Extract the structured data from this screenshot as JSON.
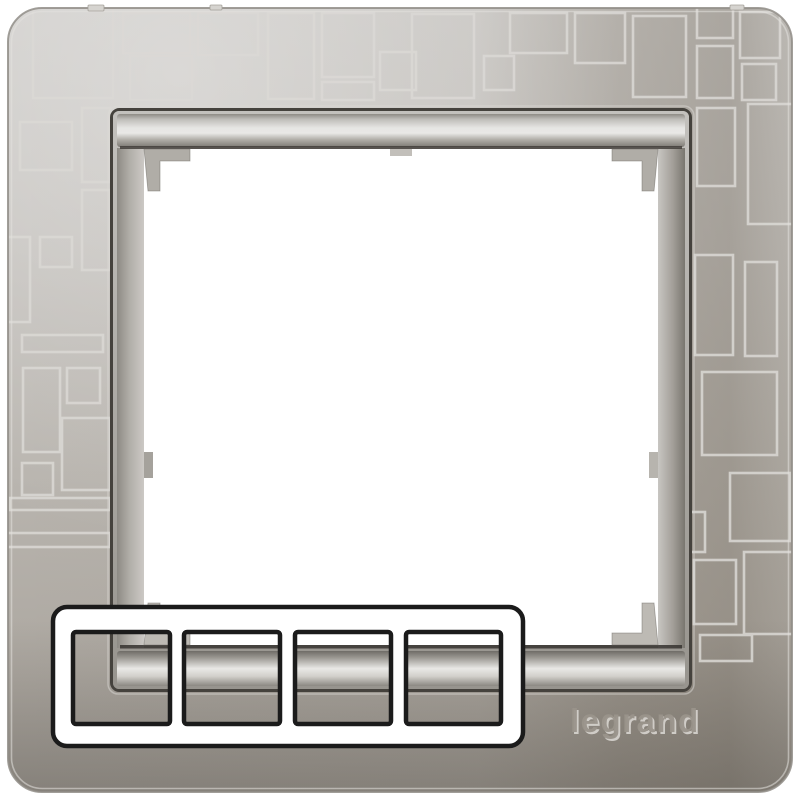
{
  "scene": {
    "description": "Legrand aluminium single wall-plate frame with modern square pattern, 4-gang schematic overlay",
    "background": "#ffffff"
  },
  "brand_logo": {
    "text": "legrand"
  },
  "colors": {
    "background": "#ffffff",
    "face_silver": "#c0bdb8",
    "face_shadow": "#9c958a",
    "pattern_line": "#dbd9d5",
    "bezel_groove": "#45423d",
    "window": "#ffffff",
    "diagram_stroke": "#1b1b1b",
    "diagram_fill": "#ffffff",
    "logo_emboss": "#9a948b"
  },
  "pattern": {
    "line_color": "#dbd9d5",
    "rects": [
      [
        33,
        8,
        80,
        90
      ],
      [
        123,
        13,
        67,
        40
      ],
      [
        198,
        13,
        60,
        42
      ],
      [
        130,
        56,
        62,
        44
      ],
      [
        268,
        13,
        46,
        86
      ],
      [
        322,
        13,
        52,
        64
      ],
      [
        322,
        82,
        52,
        18
      ],
      [
        380,
        52,
        36,
        38
      ],
      [
        412,
        14,
        62,
        84
      ],
      [
        484,
        56,
        30,
        34
      ],
      [
        510,
        13,
        57,
        40
      ],
      [
        575,
        13,
        50,
        50
      ],
      [
        633,
        16,
        53,
        81
      ],
      [
        697,
        7,
        36,
        31
      ],
      [
        740,
        12,
        40,
        46
      ],
      [
        697,
        46,
        36,
        52
      ],
      [
        742,
        64,
        34,
        36
      ],
      [
        20,
        122,
        52,
        48
      ],
      [
        82,
        108,
        28,
        74
      ],
      [
        82,
        190,
        28,
        80
      ],
      [
        40,
        237,
        32,
        30
      ],
      [
        7,
        237,
        23,
        85
      ],
      [
        22,
        335,
        81,
        17
      ],
      [
        23,
        368,
        37,
        84
      ],
      [
        67,
        368,
        33,
        35
      ],
      [
        62,
        418,
        48,
        72
      ],
      [
        22,
        463,
        31,
        32
      ],
      [
        10,
        498,
        100,
        12
      ],
      [
        7,
        533,
        103,
        14
      ],
      [
        697,
        108,
        38,
        78
      ],
      [
        748,
        104,
        46,
        120
      ],
      [
        695,
        255,
        38,
        100
      ],
      [
        745,
        262,
        32,
        94
      ],
      [
        702,
        372,
        75,
        83
      ],
      [
        730,
        473,
        60,
        68
      ],
      [
        688,
        512,
        17,
        40
      ],
      [
        694,
        560,
        42,
        64
      ],
      [
        744,
        552,
        50,
        82
      ],
      [
        700,
        635,
        52,
        26
      ]
    ]
  },
  "diagram": {
    "gang_count": 4,
    "fill": "#ffffff",
    "stroke": "#1b1b1b",
    "stroke_width": 4.5,
    "outer": {
      "x": 53,
      "y": 607,
      "w": 470,
      "h": 139,
      "r": 14
    },
    "squares": [
      [
        73,
        632,
        97,
        92
      ],
      [
        184,
        632,
        96,
        92
      ],
      [
        295,
        632,
        96,
        92
      ],
      [
        406,
        632,
        95,
        92
      ]
    ]
  }
}
